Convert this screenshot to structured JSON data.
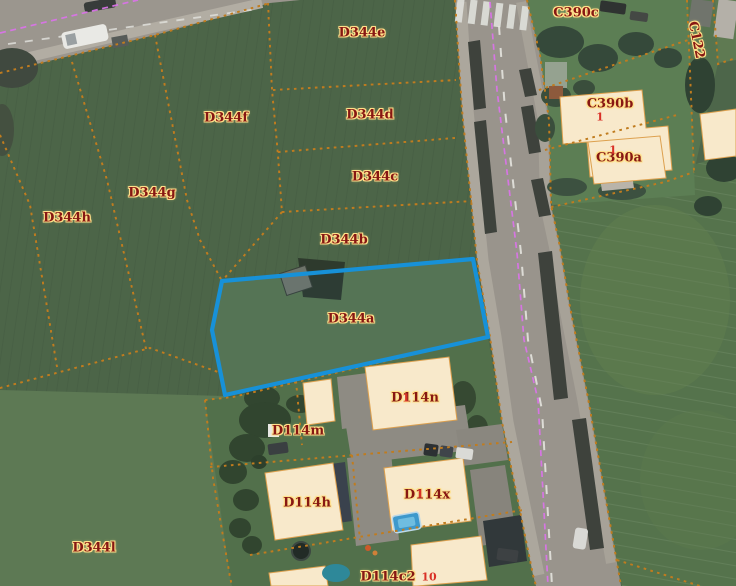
{
  "map": {
    "description": "Aerial cadastral parcel map with selected parcel",
    "colors": {
      "parcel-line": "#f7c14a",
      "parcel-line-dark": "#c07c1f",
      "parcel-label": "#871713",
      "label-halo": "#ffe08a",
      "selection": "#1791d8",
      "house-number": "#d93025",
      "utility-line": "#d973e8",
      "building-fill": "#f8e9cb",
      "building-outline": "#dda04e"
    },
    "selected_parcel": {
      "id": "D344a",
      "outline": "222,281 473,259 488,337 225,395 212,330"
    },
    "parcel_labels": [
      {
        "text": "D344e",
        "x": 362,
        "y": 33
      },
      {
        "text": "D344d",
        "x": 370,
        "y": 115
      },
      {
        "text": "D344c",
        "x": 375,
        "y": 177
      },
      {
        "text": "D344f",
        "x": 226,
        "y": 118
      },
      {
        "text": "D344g",
        "x": 152,
        "y": 193
      },
      {
        "text": "D344h",
        "x": 67,
        "y": 218
      },
      {
        "text": "D344b",
        "x": 344,
        "y": 240
      },
      {
        "text": "D344a",
        "x": 351,
        "y": 319
      },
      {
        "text": "D344l",
        "x": 94,
        "y": 548
      },
      {
        "text": "D114m",
        "x": 298,
        "y": 431
      },
      {
        "text": "D114n",
        "x": 415,
        "y": 398
      },
      {
        "text": "D114h",
        "x": 307,
        "y": 503
      },
      {
        "text": "D114x",
        "x": 427,
        "y": 495
      },
      {
        "text": "D114c2",
        "x": 388,
        "y": 577
      },
      {
        "text": "C390c",
        "x": 576,
        "y": 13
      },
      {
        "text": "C390b",
        "x": 610,
        "y": 104
      },
      {
        "text": "C390a",
        "x": 619,
        "y": 158
      },
      {
        "text": "C122",
        "x": 696,
        "y": 40,
        "rot": 78
      }
    ],
    "house_numbers": [
      {
        "text": "1",
        "x": 600,
        "y": 117
      },
      {
        "text": "1",
        "x": 613,
        "y": 150
      },
      {
        "text": "1",
        "x": 406,
        "y": 398
      },
      {
        "text": "1",
        "x": 420,
        "y": 494
      },
      {
        "text": "10",
        "x": 429,
        "y": 577
      }
    ]
  }
}
